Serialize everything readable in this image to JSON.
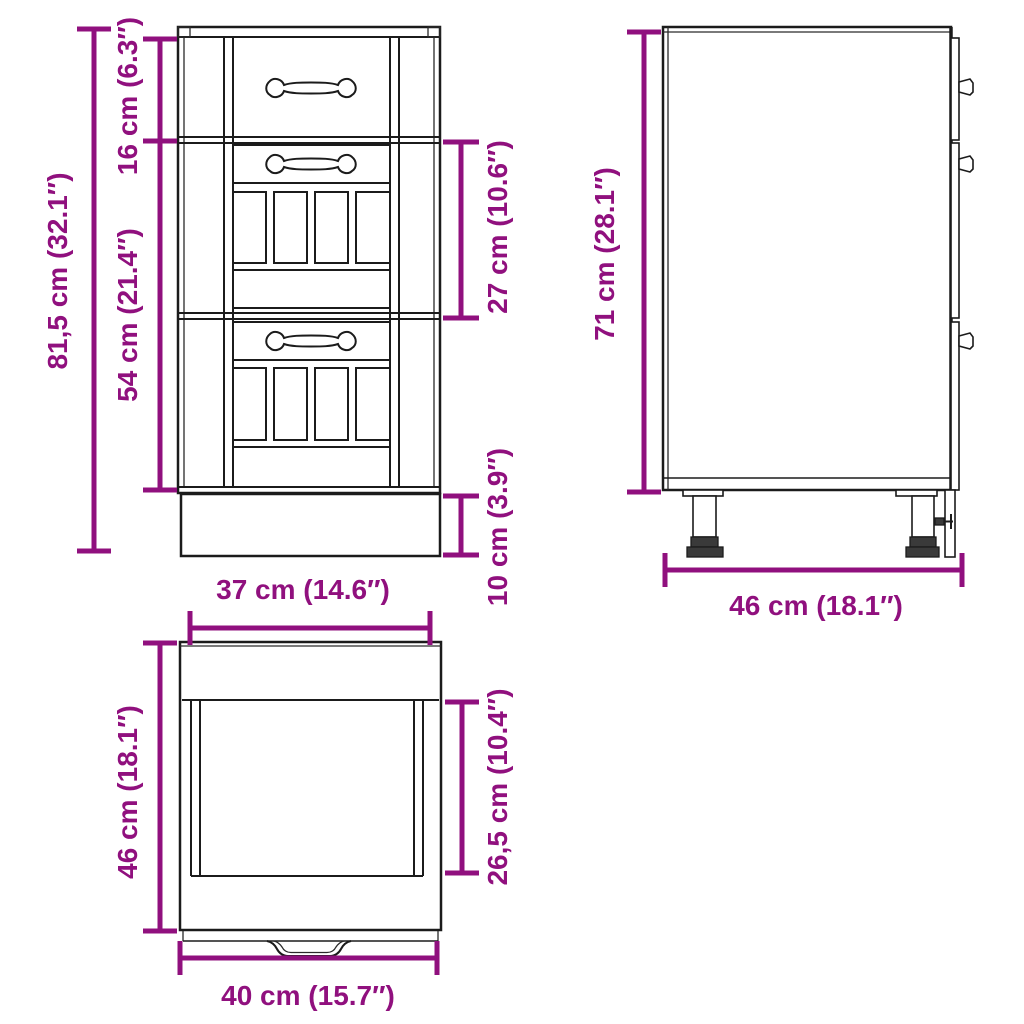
{
  "title": "Cabinet dimension drawing",
  "colors": {
    "dimension": "#90107E",
    "outline": "#1B1B1B",
    "background": "#FFFFFF"
  },
  "views": {
    "front": {
      "name": "Front view",
      "overall_height": "81,5 cm (32.1″)",
      "top_drawer_height": "16 cm (6.3″)",
      "lower_front_height": "54 cm (21.4″)",
      "middle_drawer_height": "27 cm (10.6″)",
      "plinth_height": "10 cm (3.9″)",
      "front_width": "37 cm (14.6″)"
    },
    "side": {
      "name": "Side view",
      "carcass_height": "71 cm (28.1″)",
      "depth": "46 cm (18.1″)"
    },
    "top": {
      "name": "Top view",
      "depth": "46 cm (18.1″)",
      "inner_depth": "26,5 cm (10.4″)",
      "width": "40 cm (15.7″)"
    }
  }
}
